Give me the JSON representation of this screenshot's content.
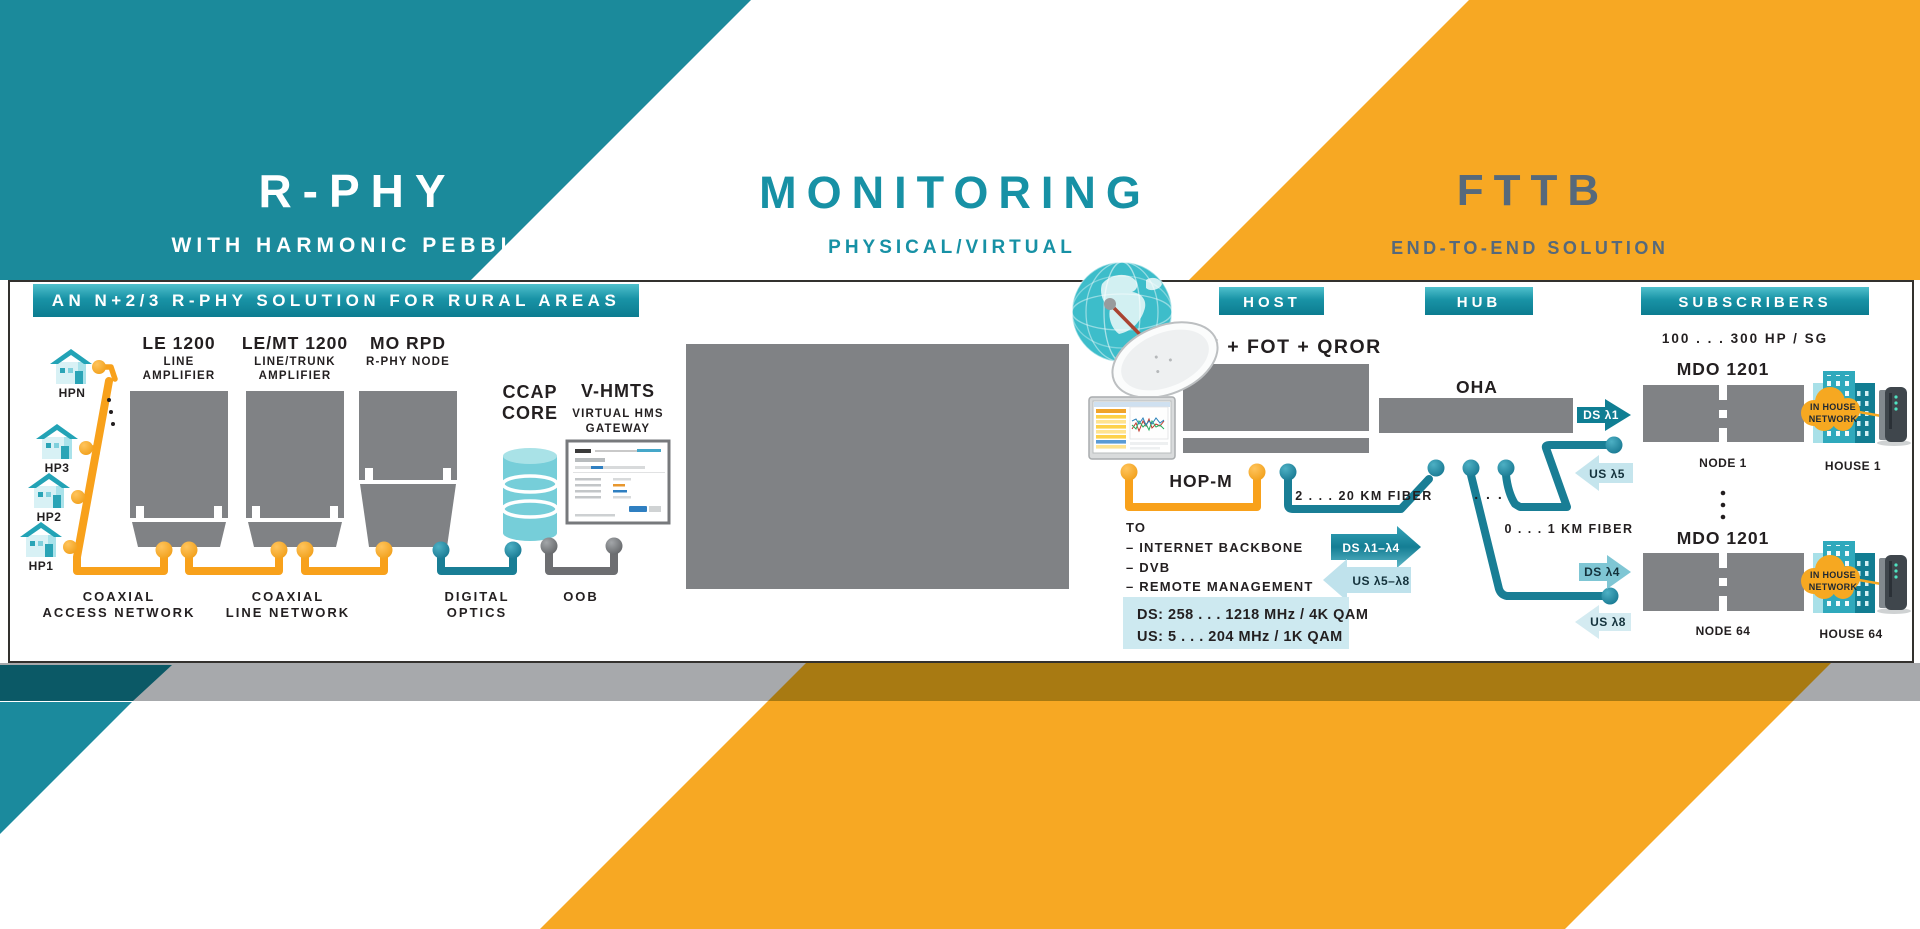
{
  "header": {
    "rphy_title": "R-PHY",
    "rphy_subtitle": "WITH HARMONIC PEBBLE",
    "monitoring_title": "MONITORING",
    "monitoring_subtitle": "PHYSICAL/VIRTUAL",
    "fttb_title": "FTTB",
    "fttb_subtitle": "END-TO-END SOLUTION"
  },
  "colors": {
    "teal": "#1b8a9b",
    "dark_teal": "#0b5966",
    "orange": "#f7a823",
    "slate": "#56697b",
    "device_gray": "#808285",
    "band_gray": "#a7a9ac",
    "gold_overlap": "#a87a12",
    "spec_box_blue": "#cde9f0",
    "connector_orange": "#f8a11b",
    "connector_teal": "#197e95",
    "connector_gray": "#6d6e71"
  },
  "rphy": {
    "banner": "AN N+2/3 R-PHY SOLUTION FOR RURAL AREAS",
    "houses": [
      {
        "label": "HPN"
      },
      {
        "label": "HP3"
      },
      {
        "label": "HP2"
      },
      {
        "label": "HP1"
      }
    ],
    "devices": [
      {
        "name": "LE 1200",
        "desc_line1": "LINE",
        "desc_line2": "AMPLIFIER"
      },
      {
        "name": "LE/MT 1200",
        "desc_line1": "LINE/TRUNK",
        "desc_line2": "AMPLIFIER"
      },
      {
        "name": "MO RPD",
        "desc_line1": "R-PHY NODE"
      }
    ],
    "ccap_line1": "CCAP",
    "ccap_line2": "CORE",
    "vhmts_name": "V-HMTS",
    "vhmts_desc_line1": "VIRTUAL HMS",
    "vhmts_desc_line2": "GATEWAY",
    "net1_line1": "COAXIAL",
    "net1_line2": "ACCESS NETWORK",
    "net2_line1": "COAXIAL",
    "net2_line2": "LINE NETWORK",
    "net3_line1": "DIGITAL",
    "net3_line2": "OPTICS",
    "net4": "OOB"
  },
  "host": {
    "badge": "HOST",
    "device": "OCM + FOT + QROR",
    "hopm": "HOP-M",
    "fiber": "2 . . . 20 KM FIBER",
    "to_title": "TO",
    "to_item1": "–  INTERNET BACKBONE",
    "to_item2": "–  DVB",
    "to_item3": "–  REMOTE MANAGEMENT",
    "ds_label": "DS λ1–λ4",
    "us_label": "US λ5–λ8",
    "spec_line1": "DS: 258 . . . 1218 MHz / 4K QAM",
    "spec_line2": "US: 5 . . . 204 MHz / 1K QAM"
  },
  "hub": {
    "badge": "HUB",
    "device": "OHA",
    "dots": ". . .",
    "fiber": "0 . . . 1 KM FIBER",
    "ds1": "DS λ1",
    "us5": "US λ5",
    "ds4": "DS λ4",
    "us8": "US λ8"
  },
  "subscribers": {
    "badge": "SUBSCRIBERS",
    "capacity": "100 . . . 300 HP / SG",
    "node1_device": "MDO 1201",
    "node1_label": "NODE 1",
    "node1_house": "HOUSE 1",
    "node1_cloud_line1": "IN HOUSE",
    "node1_cloud_line2": "NETWORK",
    "node2_device": "MDO 1201",
    "node2_label": "NODE 64",
    "node2_house": "HOUSE 64",
    "node2_cloud_line1": "IN HOUSE",
    "node2_cloud_line2": "NETWORK"
  }
}
